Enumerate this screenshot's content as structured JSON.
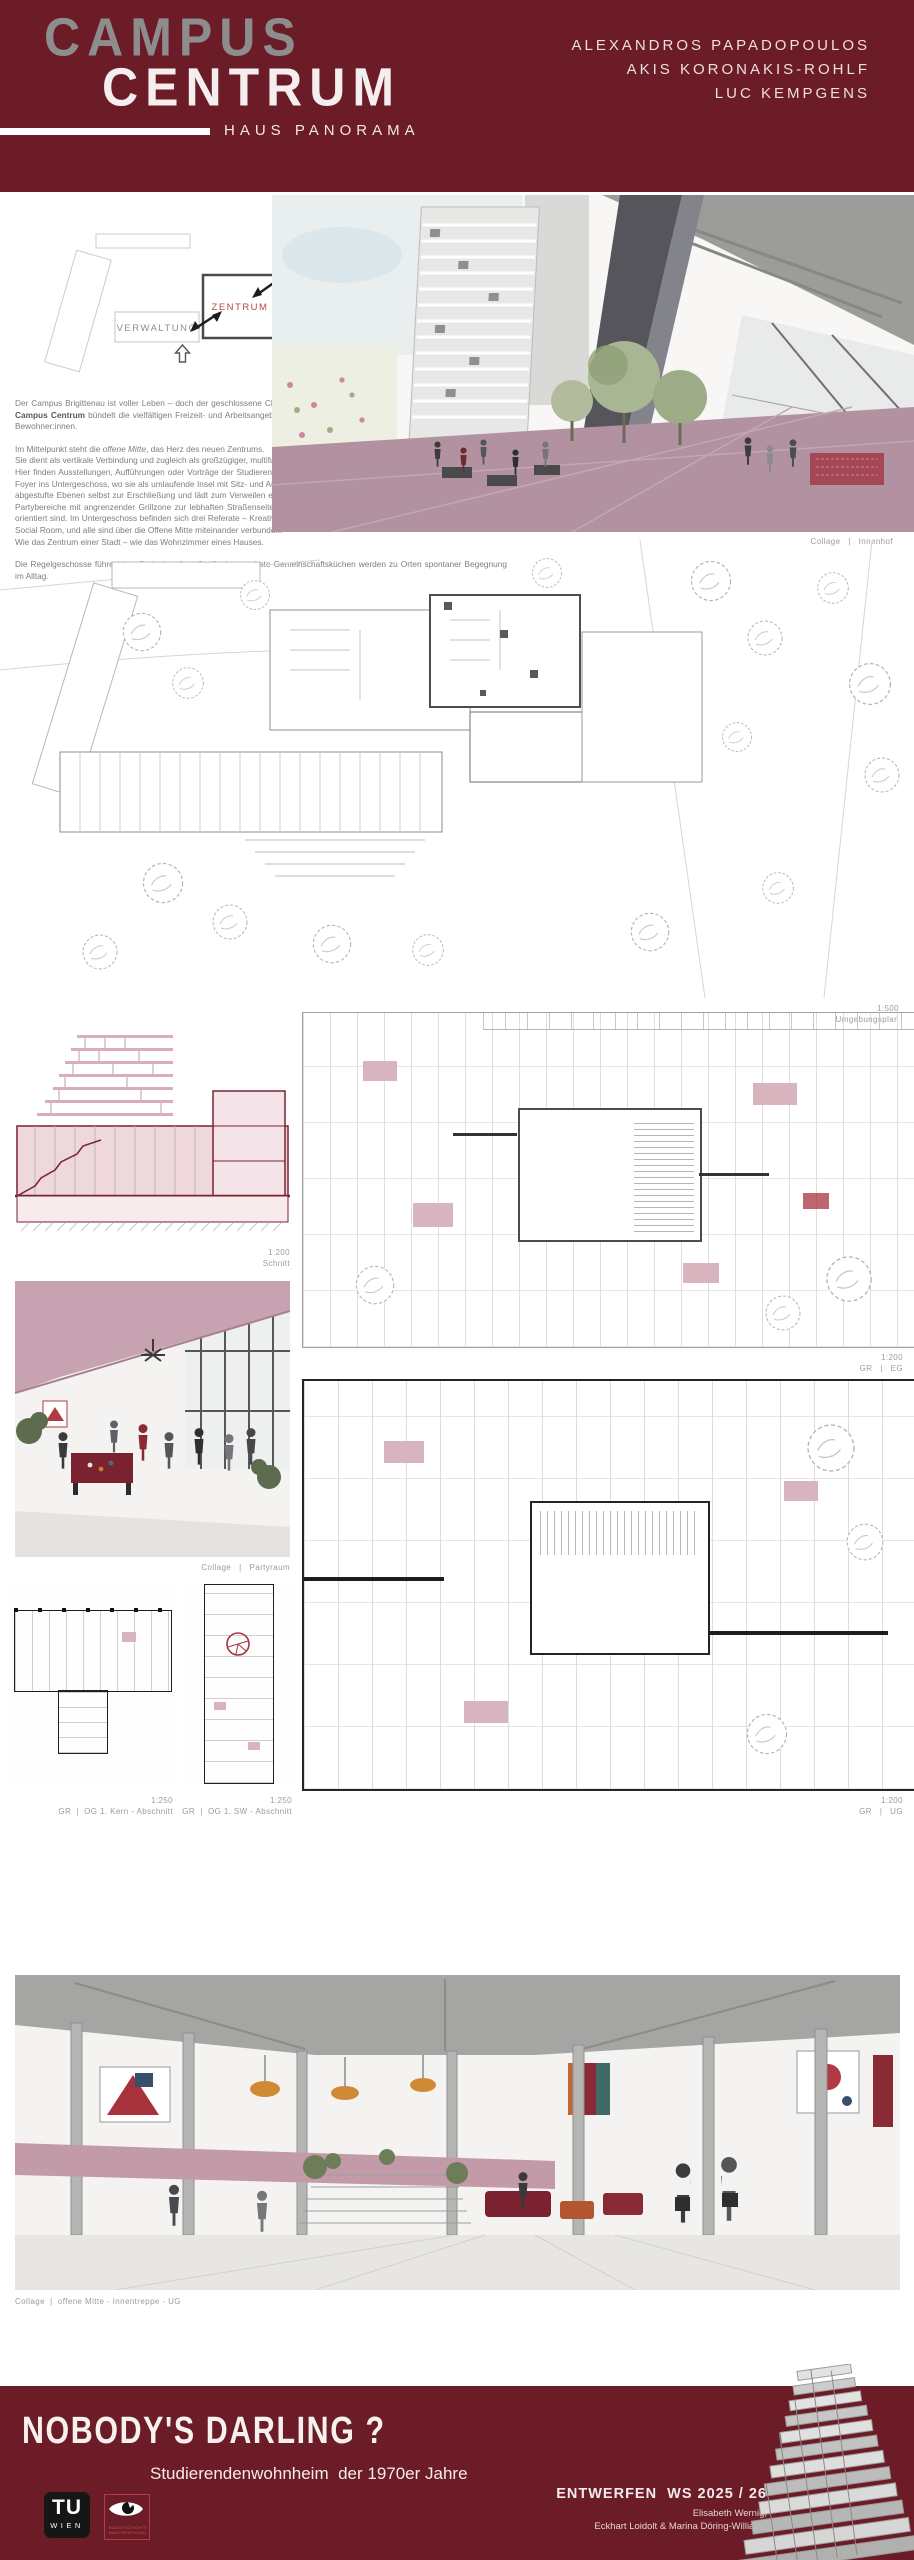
{
  "header": {
    "title_line1": "CAMPUS",
    "title_line2": "CENTRUM",
    "subtitle": "HAUS PANORAMA",
    "authors": {
      "a1": "ALEXANDROS PAPADOPOULOS",
      "a2": "AKIS KORONAKIS-ROHLF",
      "a3": "LUC KEMPGENS"
    }
  },
  "colors": {
    "maroon": "#6b1c27",
    "dusty_pink": "#c0a0ad",
    "plan_red": "#7a2230",
    "title_gray": "#8d8d8d"
  },
  "diagram": {
    "verwaltung": "VERWALTUNG",
    "zentrum": "ZENTRUM",
    "wohnen": "WOHNEN"
  },
  "intro": {
    "p1_pre": "Der Campus Brigittenau ist voller Leben – doch der geschlossene Charakter des Hauses lässt dieses Potential bisher nur erahnen. ",
    "p1_bold": "Campus Centrum",
    "p1_post": " bündelt die vielfältigen Freizeit- und Arbeitsangebote und öffnet bislang verborgene, ungenutzte Flächen für die Bewohner:innen.",
    "p2a_pre": "Im Mittelpunkt steht die ",
    "p2a_it": "offene Mitte",
    "p2a_post": ", das Herz des neuen Zentrums.",
    "p2b": "Sie dient als vertikale Verbindung und zugleich als großzügiger, multifunktionaler Begegnungsraum.",
    "p2c": "Hier finden Ausstellungen, Aufführungen oder Vorträge der Studierenden einen offenen Rahmen. Eine großzügige Treppe führt vom Foyer ins Untergeschoss, wo sie als umlaufende Insel mit Sitz- und Aufenthaltsbereichen gestaltet ist. Außen wird der Innenhof durch abgestufte Ebenen selbst zur Erschließung und lädt zum Verweilen ein.",
    "p2d": "Rund um die offene Mitte liegen im Erdgeschoss Spiel- und Partybereiche mit angrenzender Grillzone zur lebhaften Straßenseite, während zum ruhigeren Garten Lern-, Seminar- und Räume orientiert sind. Im Untergeschoss befinden sich drei Referate – Kreativ/Werkstatt, Musik und Sport. Jedes verfügt über einen eigenen Social Room, und alle sind über die Offene Mitte miteinander verbunden.",
    "p2e": "Wie das Zentrum einer Stadt – wie das Wohnzimmer eines Hauses.",
    "p3": "Die Regelgeschosse führen den Gedanken fort: Qualitativ gestaltete Gemeinschaftsküchen werden zu Orten spontaner Begegnung im Alltag."
  },
  "captions": {
    "innenhof": "Collage   |   Innenhof",
    "umg_scale": "1:500",
    "umg_label": "Umgebungsplan",
    "schnitt_scale": "1:200",
    "schnitt_label": "Schnitt",
    "eg_scale": "1:200",
    "eg_label": "GR   |   EG",
    "partyraum": "Collage   |   Partyraum",
    "kern_scale": "1:250",
    "kern_label": "GR  |  OG 1. Kern - Abschnitt",
    "sw_scale": "1:250",
    "sw_label": "GR  |  OG 1. SW - Abschnitt",
    "ug_scale": "1:200",
    "ug_label": "GR   |   UG",
    "offene_mitte": "Collage  |  offene Mitte - Innentreppe - UG"
  },
  "footer": {
    "title": "NOBODY'S DARLING ?",
    "subtitle": "Studierendenwohnheim  der 1970er Jahre",
    "course": "ENTWERFEN  WS 2025 / 26",
    "staff1": "Elisabeth Wernig,",
    "staff2": "Eckhart Loidolt & Marina Döring-Williams",
    "tu1": "TU",
    "tu2": "WIEN",
    "eye1": "BAUGESCHICHTE",
    "eye2": "BAUFORSCHUNG"
  }
}
